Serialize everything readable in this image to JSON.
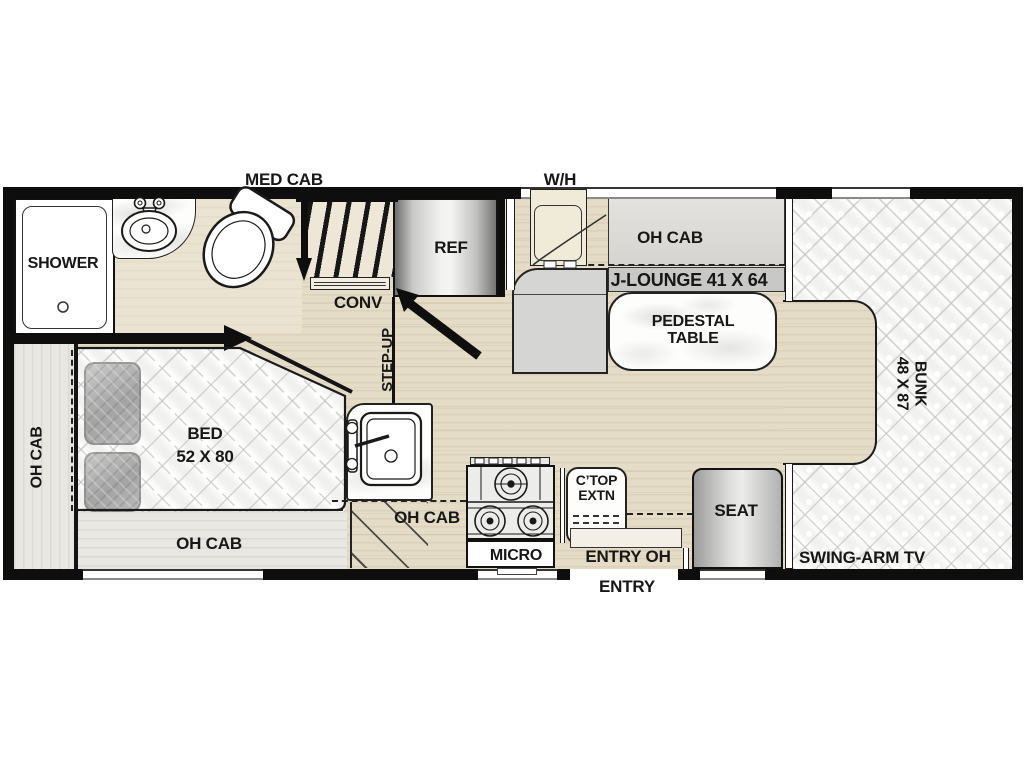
{
  "colors": {
    "wall": "#0e0e0e",
    "floor_wood": "#e5dcc8",
    "floor_light": "#e9e7e2",
    "mattress": "#f5f5f3",
    "sofa_gray": "#d5d5d3",
    "band_gray": "#c8c8c6",
    "metal_light": "#f2f2f0",
    "metal_dark": "#6f6f6d"
  },
  "exterior": {
    "med_cab": "MED CAB",
    "water_heater": "W/H",
    "entry": "ENTRY"
  },
  "bathroom": {
    "shower": "SHOWER"
  },
  "galley": {
    "conv": "CONV",
    "ref": "REF",
    "step_up": "STEP-UP",
    "micro": "MICRO",
    "oh_cab": "OH CAB",
    "ctop_line1": "C’TOP",
    "ctop_line2": "EXTN"
  },
  "dinette": {
    "oh_cab": "OH CAB",
    "j_lounge": "J-LOUNGE 41 X 64",
    "pedestal_line1": "PEDESTAL",
    "pedestal_line2": "TABLE"
  },
  "bedroom": {
    "bed_line1": "BED",
    "bed_line2": "52 X 80",
    "oh_cab_rear": "OH CAB",
    "oh_cab_bottom": "OH CAB"
  },
  "front": {
    "bunk_line1": "BUNK",
    "bunk_line2": "48 X 87",
    "seat": "SEAT",
    "swing_arm_tv": "SWING-ARM TV",
    "entry_oh": "ENTRY OH"
  }
}
